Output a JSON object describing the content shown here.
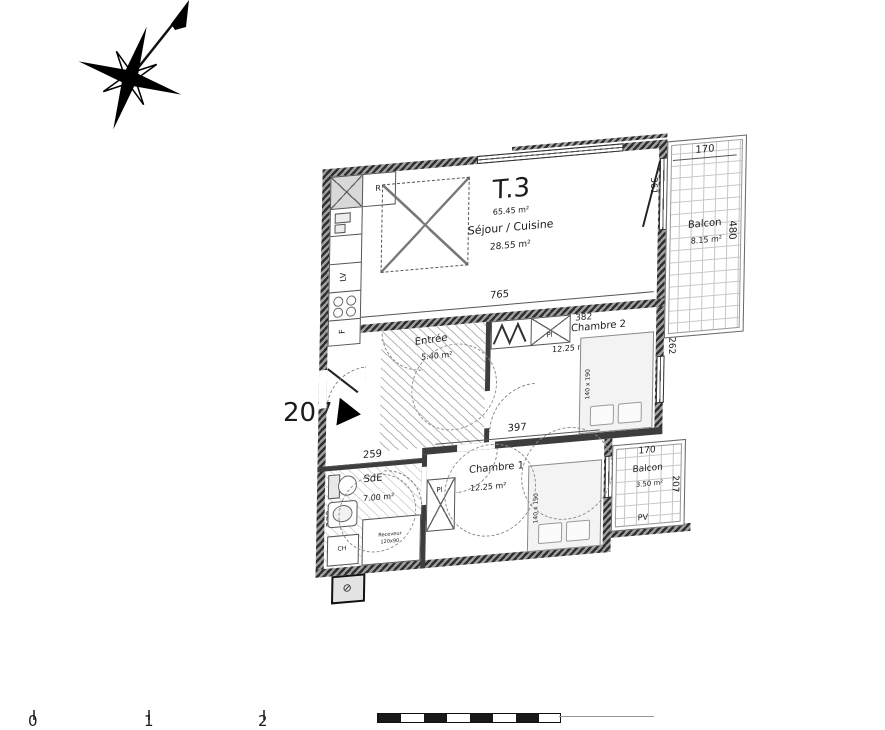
{
  "plan": {
    "title": "T.3",
    "total_area": "65.45 m²",
    "unit_number": "207",
    "rooms": {
      "sejour": {
        "name": "Séjour / Cuisine",
        "area": "28.55 m²"
      },
      "chambre2": {
        "name": "Chambre 2",
        "area": "12.25 m²"
      },
      "chambre1": {
        "name": "Chambre 1",
        "area": "12.25 m²"
      },
      "entree": {
        "name": "Entrée",
        "area": "5.40 m²"
      },
      "sde": {
        "name": "SdE",
        "area": "7.00 m²"
      },
      "balcon_nord": {
        "name": "Balcon",
        "area": "8.15 m²"
      },
      "balcon_sud": {
        "name": "Balcon",
        "area": "3.50 m²"
      }
    },
    "dims": {
      "sejour_w": "765",
      "sejour_door": "361",
      "balcon_nord_w": "170",
      "balcon_nord_d": "480",
      "chambre2_w": "382",
      "chambre2_win": "262",
      "chambre1_w": "397",
      "chambre1_d": "281",
      "sde_w": "259",
      "sde_d": "272",
      "balcon_sud_w": "170",
      "balcon_sud_d": "207"
    },
    "fixtures": {
      "fridge": "R",
      "dishwasher": "LV",
      "oven": "F",
      "closet": "Pl",
      "bed_size": "140 x 190",
      "shower_l1": "Receveur",
      "shower_l2": "120x90",
      "water_heater": "CH",
      "screen": "PV"
    },
    "scale_bar": {
      "t0": "0",
      "t1": "1",
      "t2": "2"
    }
  }
}
